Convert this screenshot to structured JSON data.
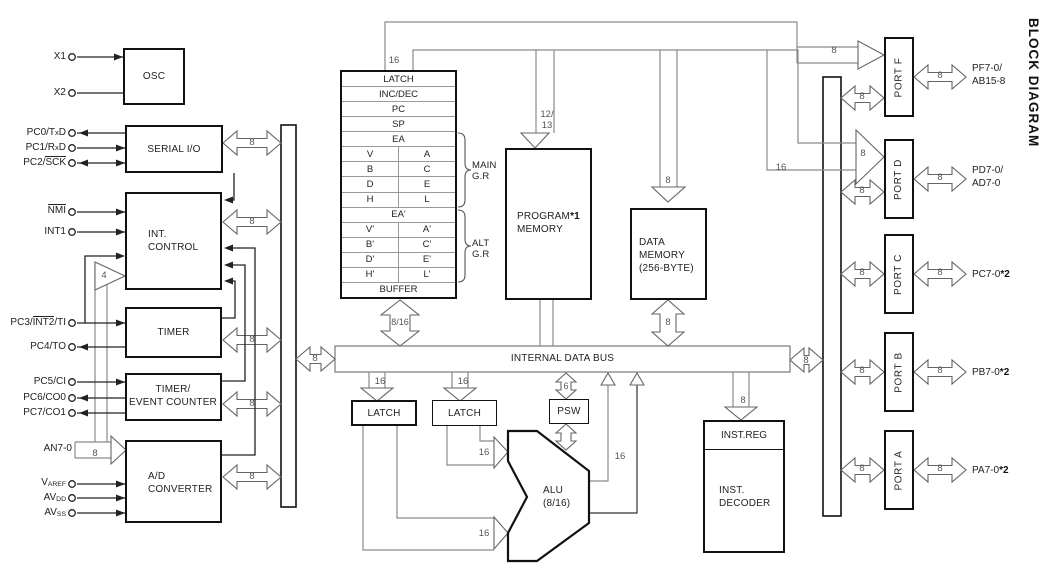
{
  "title": "BLOCK DIAGRAM",
  "blocks": {
    "osc": "OSC",
    "serial_io": "SERIAL I/O",
    "int_control_1": "INT.",
    "int_control_2": "CONTROL",
    "timer": "TIMER",
    "timer_event_1": "TIMER/",
    "timer_event_2": "EVENT COUNTER",
    "adc_1": "A/D",
    "adc_2": "CONVERTER",
    "program_memory_1": "PROGRAM",
    "program_memory_note": "*1",
    "program_memory_2": "MEMORY",
    "data_memory_1": "DATA",
    "data_memory_2": "MEMORY",
    "data_memory_3": "(256-BYTE)",
    "internal_data_bus": "INTERNAL DATA BUS",
    "latch_a": "LATCH",
    "latch_b": "LATCH",
    "psw": "PSW",
    "alu_1": "ALU",
    "alu_2": "(8/16)",
    "inst_reg": "INST.REG",
    "inst_decoder_1": "INST.",
    "inst_decoder_2": "DECODER"
  },
  "registers": {
    "r0": "LATCH",
    "r1": "INC/DEC",
    "r2": "PC",
    "r3": "SP",
    "r4": "EA",
    "r5l": "V",
    "r5r": "A",
    "r6l": "B",
    "r6r": "C",
    "r7l": "D",
    "r7r": "E",
    "r8l": "H",
    "r8r": "L",
    "r9": "EA'",
    "r10l": "V'",
    "r10r": "A'",
    "r11l": "B'",
    "r11r": "C'",
    "r12l": "D'",
    "r12r": "E'",
    "r13l": "H'",
    "r13r": "L'",
    "r14": "BUFFER",
    "main_1": "MAIN",
    "main_2": "G.R",
    "alt_1": "ALT",
    "alt_2": "G.R"
  },
  "ports": [
    {
      "name": "PORT F",
      "pin_1": "PF7-0/",
      "pin_2": "AB15-8",
      "bus_w": "8",
      "out_w": "8",
      "in_w": "8"
    },
    {
      "name": "PORT D",
      "pin_1": "PD7-0/",
      "pin_2": "AD7-0",
      "bus_w": "8",
      "out_w": "8",
      "in_w": "8",
      "addr_w": "16"
    },
    {
      "name": "PORT C",
      "pin_1": "PC7-0",
      "note": "*2",
      "bus_w": "8",
      "out_w": "8"
    },
    {
      "name": "PORT B",
      "pin_1": "PB7-0",
      "note": "*2",
      "bus_w": "8",
      "out_w": "8"
    },
    {
      "name": "PORT A",
      "pin_1": "PA7-0",
      "note": "*2",
      "bus_w": "8",
      "out_w": "8"
    }
  ],
  "pins": {
    "x1": "X1",
    "x2": "X2",
    "pc0_pre": "PC0/T",
    "pc0_sub": "x",
    "pc0_post": "D",
    "pc1_pre": "PC1/R",
    "pc1_sub": "x",
    "pc1_post": "D",
    "pc2_pre": "PC2/",
    "pc2_over": "SCK",
    "nmi_over": "NMI",
    "int1": "INT1",
    "pc3_pre": "PC3/",
    "pc3_over": "INT2",
    "pc3_post": "/TI",
    "pc4": "PC4/TO",
    "pc5": "PC5/CI",
    "pc6": "PC6/CO0",
    "pc7": "PC7/CO1",
    "an": "AN7-0",
    "varef_pre": "V",
    "varef_sub": "AREF",
    "avdd_pre": "AV",
    "avdd_sub": "DD",
    "avss_pre": "AV",
    "avss_sub": "SS"
  },
  "bus_labels": {
    "stack_16": "16",
    "pgm_in_a": "12/",
    "pgm_in_b": "13",
    "dm_in_8": "8",
    "serial_8": "8",
    "intc_8": "8",
    "intc_4": "4",
    "timer_8": "8",
    "tec_8": "8",
    "adc_8": "8",
    "an_8": "8",
    "stack_bus": "8/16",
    "dm_bus_8": "8",
    "idb_left_8": "8",
    "idb_right_8": "8",
    "latch_a_16": "16",
    "latch_b_16": "16",
    "psw_6": "6",
    "alu_in_a_16": "16",
    "alu_in_b_16": "16",
    "alu_out_16": "16",
    "inst_8": "8"
  }
}
